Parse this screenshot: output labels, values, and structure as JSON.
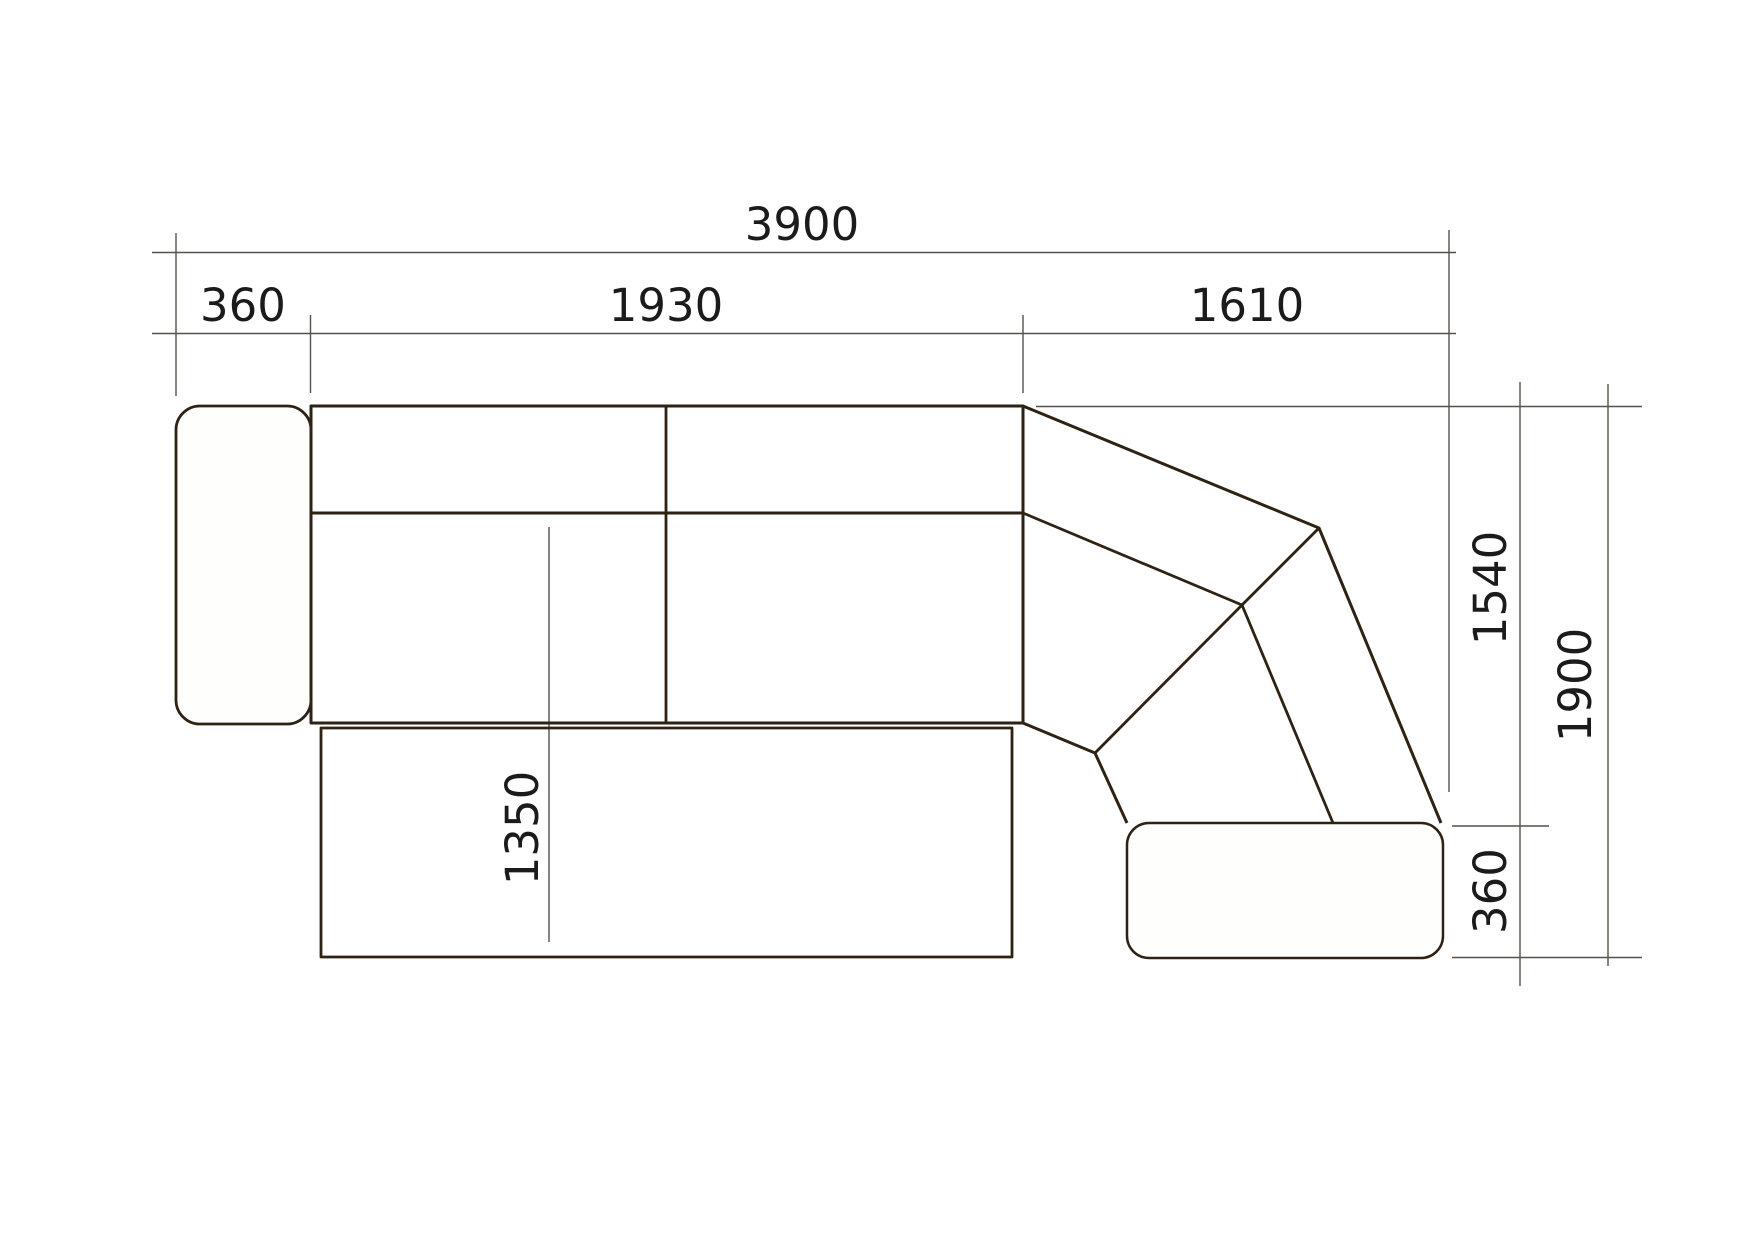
{
  "dimension_labels": {
    "total_width": "3900",
    "armrest_width": "360",
    "main_section_width": "1930",
    "corner_section_width": "1610",
    "corner_side_height": "1540",
    "right_total_height": "1900",
    "ottoman_depth": "360",
    "chaise_length": "1350"
  },
  "colors": {
    "background": "#ffffff",
    "outline": "#2e2214",
    "dimension_line": "#55504a",
    "label_text": "#1b1b1b"
  }
}
